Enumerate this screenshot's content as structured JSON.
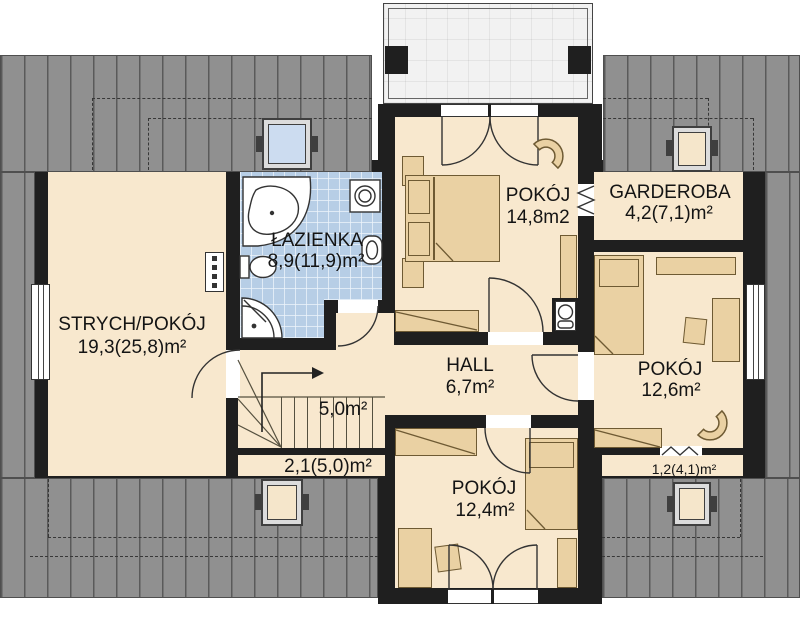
{
  "plan_title": "Floor plan - upper storey",
  "colors": {
    "wall": "#1f1f1f",
    "room_fill": "#f8e8ce",
    "bathroom_fill": "#b7cee6",
    "roof": "#909090",
    "furniture": "#ead1a3",
    "text": "#141414"
  },
  "rooms": [
    {
      "name": "STRYCH/POKÓJ",
      "area": "19,3(25,8)m²"
    },
    {
      "name": "ŁAZIENKA",
      "area": "8,9(11,9)m²"
    },
    {
      "name": "POKÓJ",
      "area": "14,8m2"
    },
    {
      "name": "GARDEROBA",
      "area": "4,2(7,1)m²"
    },
    {
      "name": "POKÓJ",
      "area": "12,6m²"
    },
    {
      "name": "HALL",
      "area": "6,7m²"
    },
    {
      "name": "POKÓJ",
      "area": "12,4m²"
    }
  ],
  "areas": [
    {
      "label": "5,0m²"
    },
    {
      "label": "2,1(5,0)m²"
    },
    {
      "label": "1,2(4,1)m²"
    }
  ]
}
